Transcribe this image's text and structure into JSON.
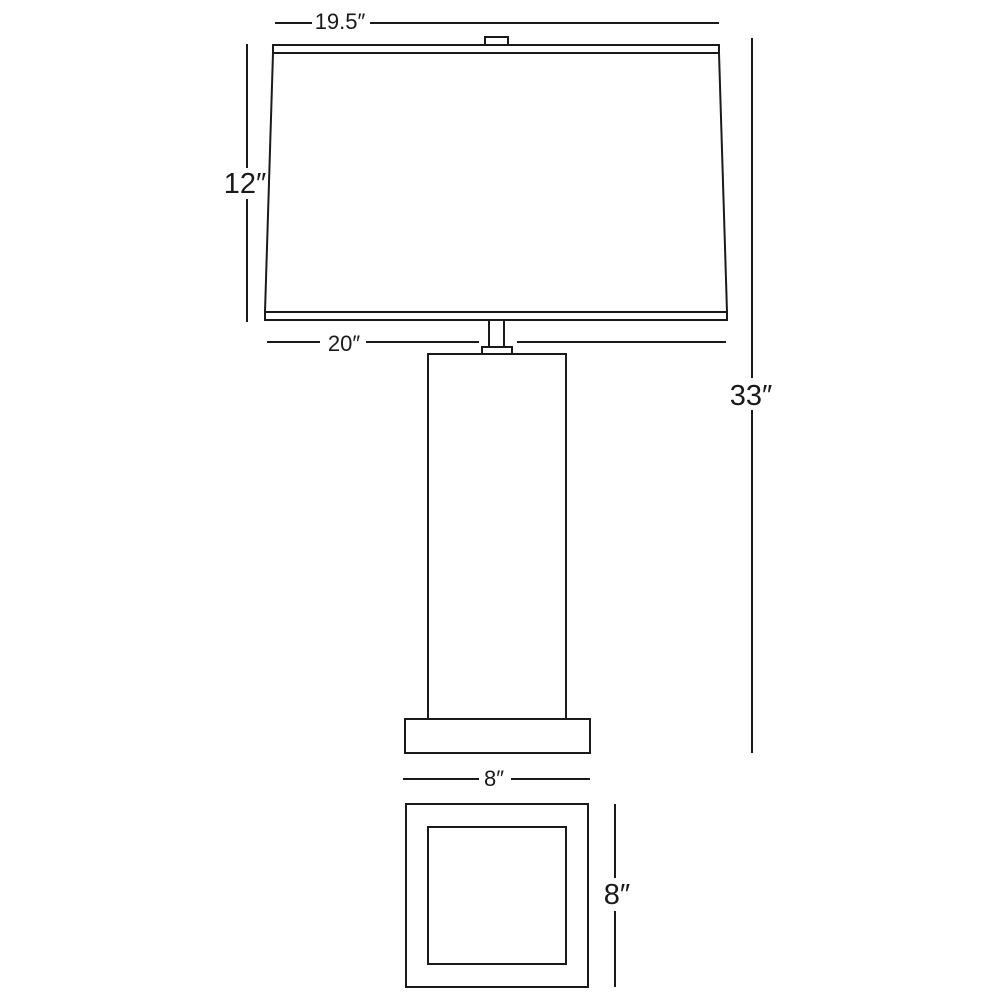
{
  "diagram": {
    "background_color": "#ffffff",
    "line_color": "#1a1a1a",
    "labels": {
      "shade_top_width": "19.5″",
      "shade_height": "12″",
      "shade_bottom_width": "20″",
      "overall_height": "33″",
      "base_width": "8″",
      "base_depth": "8″"
    }
  }
}
